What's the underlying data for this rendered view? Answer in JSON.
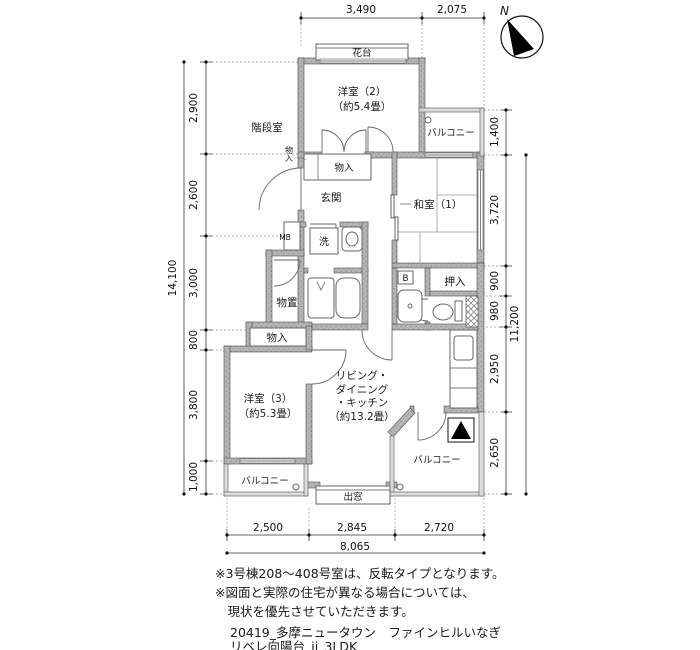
{
  "compass": {
    "label": "N"
  },
  "rooms": {
    "stairwell": "階段室",
    "flower_stand": "花台",
    "western2": "洋室（2）",
    "western2_size": "（約5.4畳）",
    "balcony_top": "バルコニー",
    "closet_small": "物入",
    "closet_hall": "物入",
    "entrance": "玄関",
    "japanese1": "和室（1）",
    "meter_box": "MB",
    "laundry": "洗",
    "bath": "B",
    "oshiire": "押入",
    "storage_shed": "物置",
    "closet3": "物入",
    "western3": "洋室（3）",
    "western3_size": "（約5.3畳）",
    "ldk_line1": "リビング・",
    "ldk_line2": "ダイニング",
    "ldk_line3": "・キッチン",
    "ldk_line4": "（約13.2畳）",
    "balcony_left": "バルコニー",
    "balcony_right": "バルコニー",
    "bay_window": "出窓"
  },
  "dimensions": {
    "top": [
      "3,490",
      "2,075"
    ],
    "left": [
      "2,900",
      "2,600",
      "3,000",
      "800",
      "3,800",
      "1,000"
    ],
    "left_total": "14,100",
    "right": [
      "1,400",
      "3,720",
      "900",
      "980",
      "2,950",
      "2,650"
    ],
    "right_total": "11,200",
    "bottom": [
      "2,500",
      "2,845",
      "2,720"
    ],
    "bottom_total": "8,065"
  },
  "notes": {
    "line1": "※3号棟208〜408号室は、反転タイプとなります。",
    "line2": "※図面と実際の住宅が異なる場合については、",
    "line3": "　現状を優先させていただきます。"
  },
  "footer": {
    "line1": "20419_多摩ニュータウン　ファインヒルいなぎ",
    "line2": "リベレ向陽台_jj_3LDK"
  }
}
